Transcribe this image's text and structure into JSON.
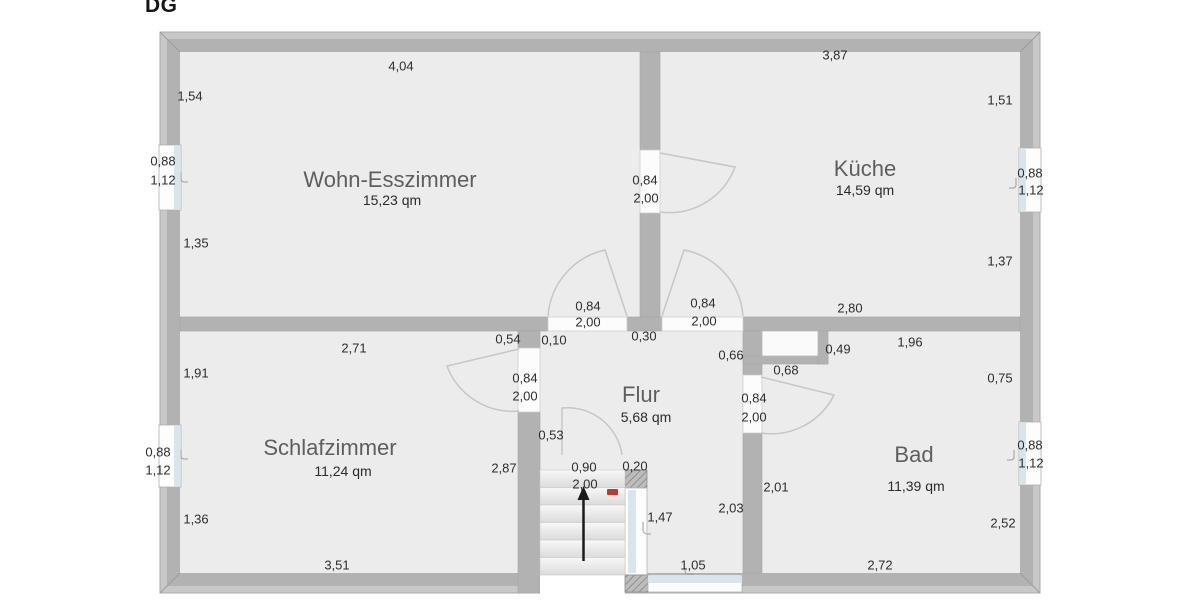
{
  "title": "DG",
  "floor_plan": {
    "rooms": [
      {
        "name": "Wohn-Esszimmer",
        "area": "15,23 qm"
      },
      {
        "name": "Küche",
        "area": "14,59 qm"
      },
      {
        "name": "Schlafzimmer",
        "area": "11,24 qm"
      },
      {
        "name": "Flur",
        "area": "5,68 qm"
      },
      {
        "name": "Bad",
        "area": "11,39 qm"
      }
    ],
    "measurements": [
      {
        "text": "4,04",
        "x": 401,
        "y": 66
      },
      {
        "text": "3,87",
        "x": 835,
        "y": 55
      },
      {
        "text": "1,54",
        "x": 190,
        "y": 96
      },
      {
        "text": "1,51",
        "x": 1000,
        "y": 100
      },
      {
        "text": "0,88",
        "x": 163,
        "y": 161
      },
      {
        "text": "1,12",
        "x": 163,
        "y": 180
      },
      {
        "text": "0,84",
        "x": 645,
        "y": 180
      },
      {
        "text": "2,00",
        "x": 646,
        "y": 198
      },
      {
        "text": "1,35",
        "x": 196,
        "y": 243
      },
      {
        "text": "1,37",
        "x": 1000,
        "y": 261
      },
      {
        "text": "0,88",
        "x": 1030,
        "y": 173
      },
      {
        "text": "1,12",
        "x": 1031,
        "y": 190
      },
      {
        "text": "0,84",
        "x": 588,
        "y": 306
      },
      {
        "text": "2,00",
        "x": 588,
        "y": 322
      },
      {
        "text": "0,84",
        "x": 703,
        "y": 303
      },
      {
        "text": "2,00",
        "x": 704,
        "y": 321
      },
      {
        "text": "0,30",
        "x": 644,
        "y": 336
      },
      {
        "text": "2,80",
        "x": 850,
        "y": 308
      },
      {
        "text": "0,54",
        "x": 508,
        "y": 339
      },
      {
        "text": "0,10",
        "x": 554,
        "y": 340
      },
      {
        "text": "2,71",
        "x": 354,
        "y": 348
      },
      {
        "text": "0,66",
        "x": 731,
        "y": 355
      },
      {
        "text": "0,49",
        "x": 838,
        "y": 349
      },
      {
        "text": "1,96",
        "x": 910,
        "y": 342
      },
      {
        "text": "0,68",
        "x": 786,
        "y": 370
      },
      {
        "text": "1,91",
        "x": 196,
        "y": 373
      },
      {
        "text": "0,75",
        "x": 1000,
        "y": 378
      },
      {
        "text": "0,84",
        "x": 525,
        "y": 378
      },
      {
        "text": "2,00",
        "x": 525,
        "y": 396
      },
      {
        "text": "0,84",
        "x": 754,
        "y": 398
      },
      {
        "text": "2,00",
        "x": 754,
        "y": 417
      },
      {
        "text": "0,53",
        "x": 551,
        "y": 435
      },
      {
        "text": "0,88",
        "x": 158,
        "y": 452
      },
      {
        "text": "1,12",
        "x": 158,
        "y": 470
      },
      {
        "text": "0,88",
        "x": 1030,
        "y": 445
      },
      {
        "text": "1,12",
        "x": 1031,
        "y": 463
      },
      {
        "text": "2,87",
        "x": 504,
        "y": 468
      },
      {
        "text": "0,90",
        "x": 584,
        "y": 467
      },
      {
        "text": "0,20",
        "x": 635,
        "y": 466
      },
      {
        "text": "2,00",
        "x": 585,
        "y": 484
      },
      {
        "text": "1,47",
        "x": 660,
        "y": 517
      },
      {
        "text": "2,03",
        "x": 731,
        "y": 508
      },
      {
        "text": "2,01",
        "x": 776,
        "y": 487
      },
      {
        "text": "1,36",
        "x": 196,
        "y": 519
      },
      {
        "text": "2,52",
        "x": 1003,
        "y": 523
      },
      {
        "text": "1,05",
        "x": 693,
        "y": 565
      },
      {
        "text": "2,72",
        "x": 880,
        "y": 565
      },
      {
        "text": "3,51",
        "x": 337,
        "y": 565
      }
    ],
    "stairs": {
      "direction": "up",
      "icon": "up-arrow"
    },
    "colors": {
      "wall_outer": "#c8c8c8",
      "wall_inner": "#b2b2b2",
      "floor": "#ececec",
      "window_glass": "#d8e5ed",
      "door_arc": "#c6c6c6",
      "marker_red": "#c0392b",
      "arrow": "#1a1a1a"
    }
  }
}
